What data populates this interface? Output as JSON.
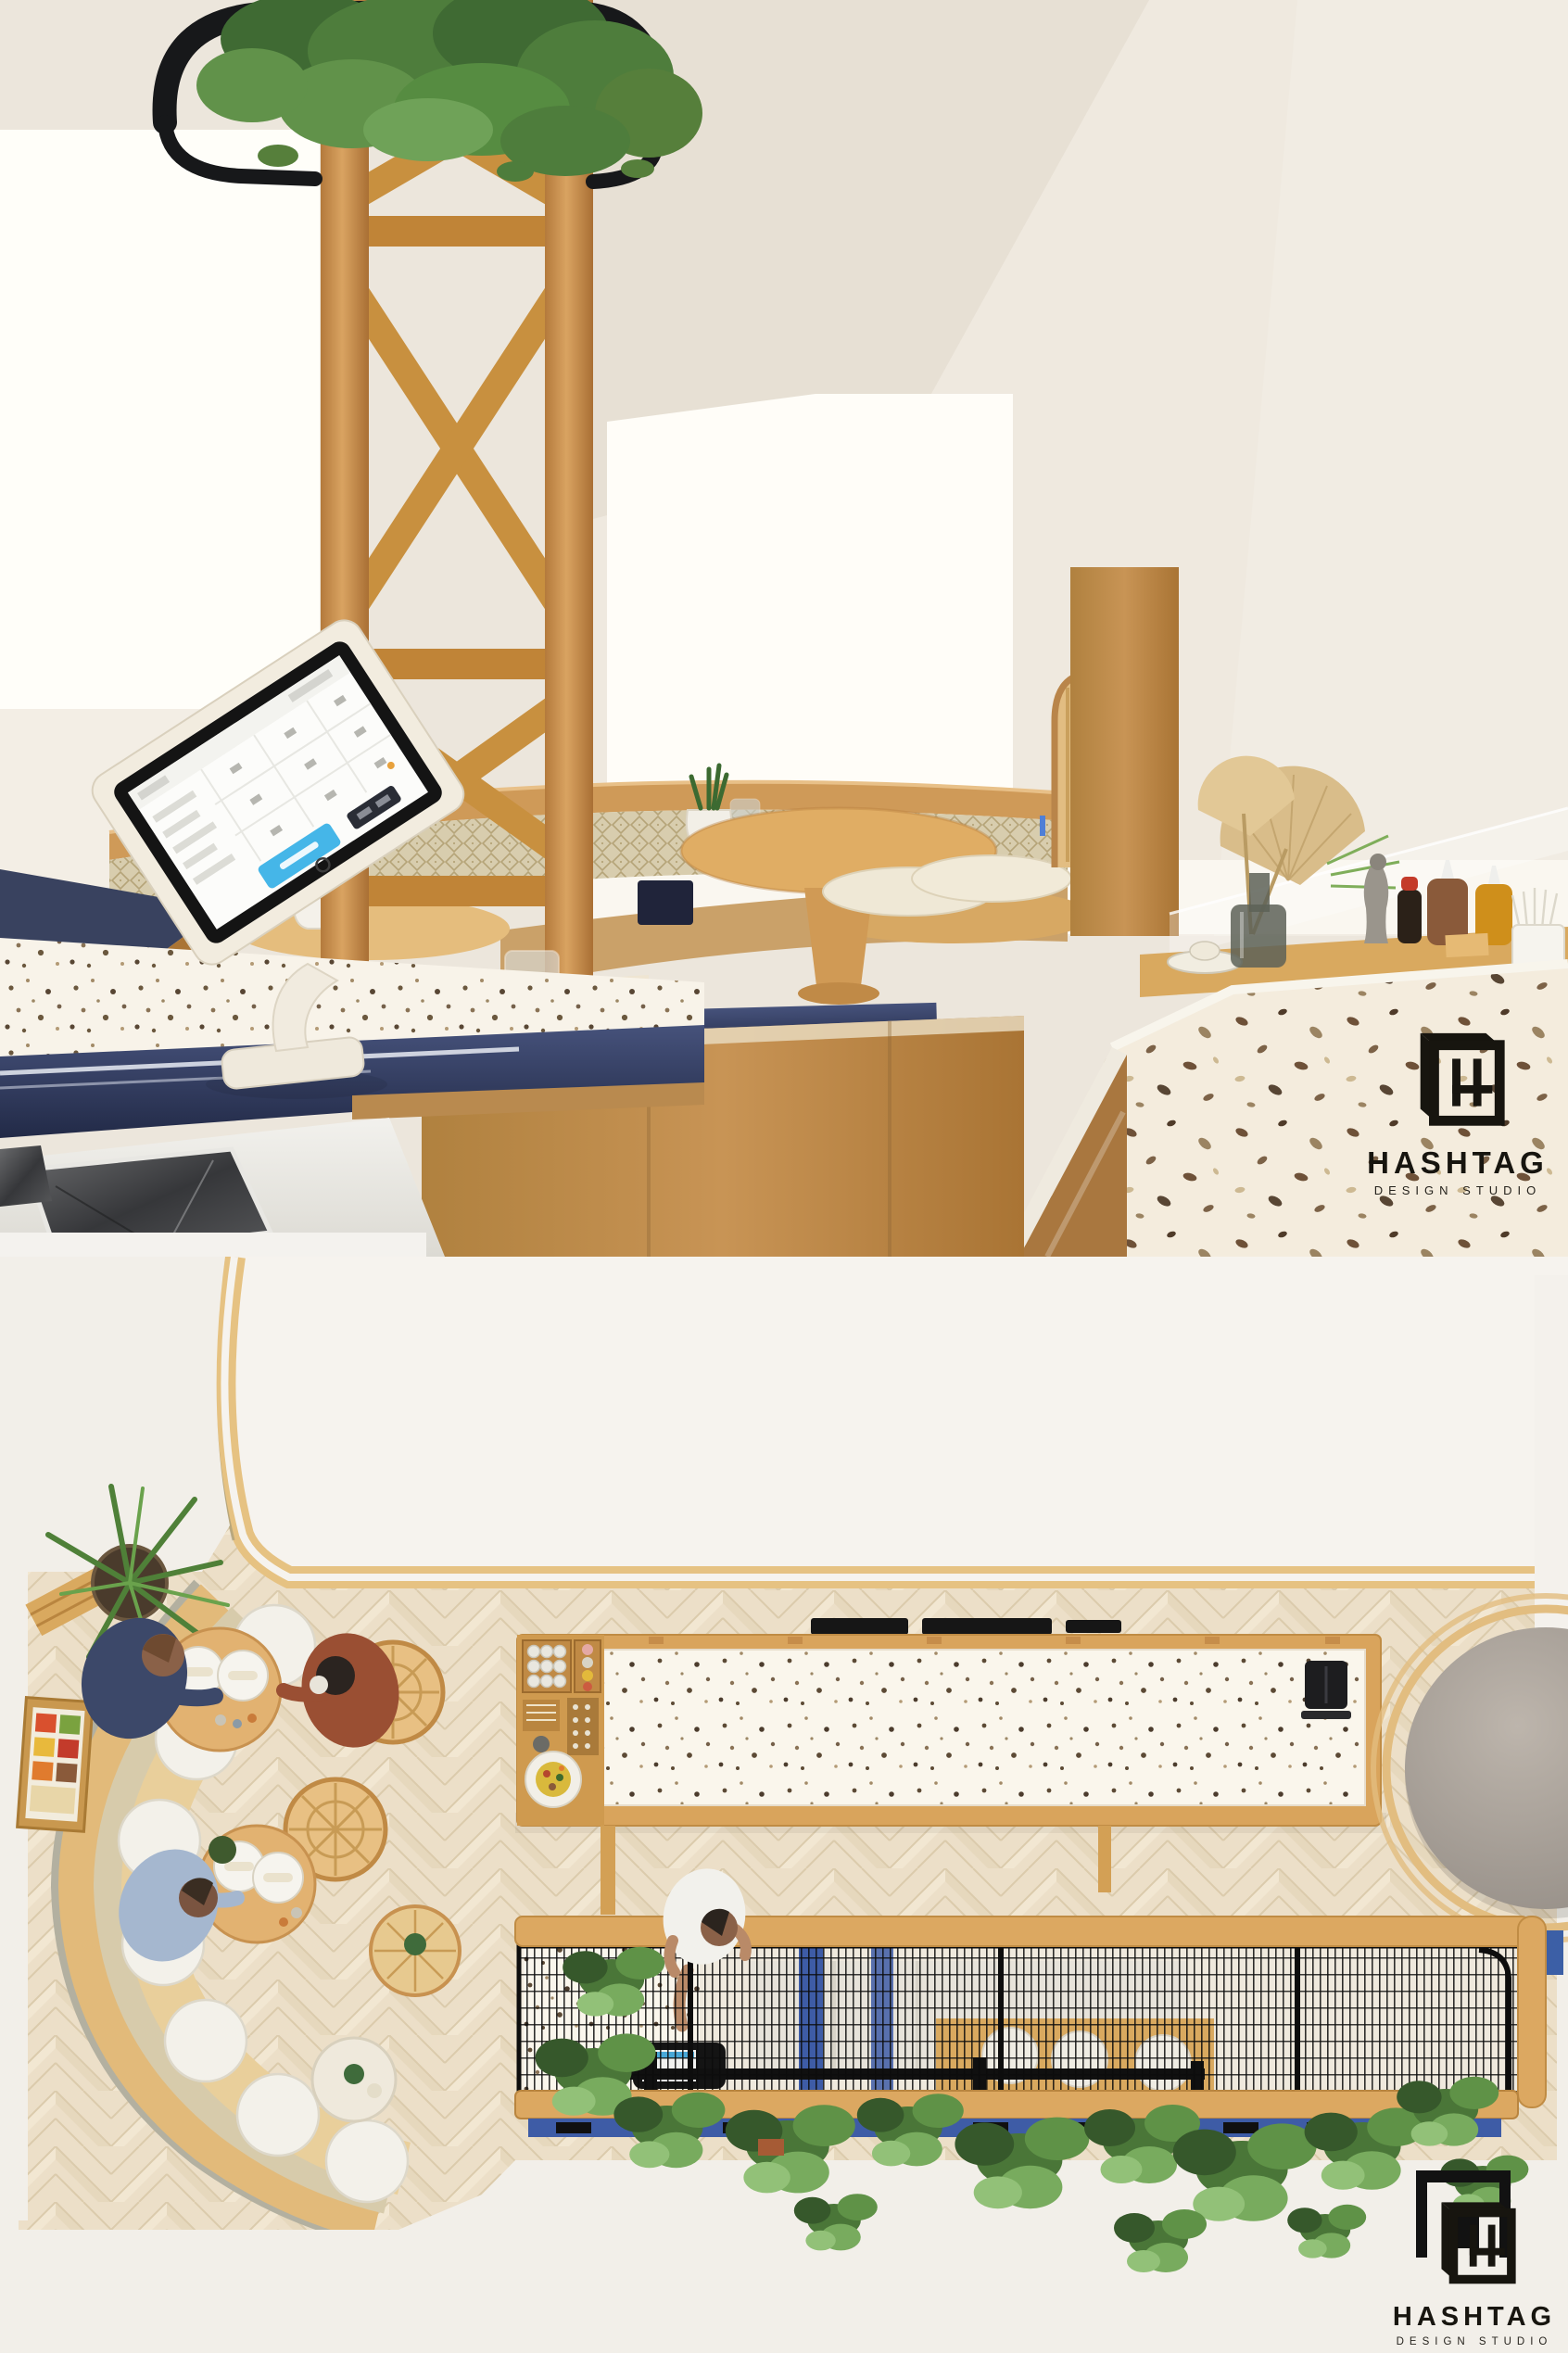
{
  "watermark": {
    "brand": "HASHTAG",
    "tagline": "DESIGN STUDIO"
  },
  "scene": {
    "type": "interior-design-render",
    "subject": "Cafe interior visualization: perspective view of service counters (top half) and top-down floor plan view (bottom half)",
    "views": [
      {
        "id": "perspective",
        "label": "Counter and seating perspective view",
        "elements": [
          "tree-canopy",
          "black-steel-planter-ring",
          "timber-x-braced-column",
          "pos-tablet-on-stand",
          "navy-counter-edges",
          "terrazzo-countertops",
          "stainless-steel-sink",
          "curved-booth-bench",
          "patterned-booth-cushions",
          "round-timber-pedestal-table",
          "potted-succulents",
          "plates-and-bowls",
          "wicker-chair",
          "timber-partition-panel",
          "glass-vase-with-dried-palm",
          "condiment-bottles",
          "pepper-grinder",
          "chopstick-cup",
          "glass-sneeze-guard",
          "terrazzo-island-counter",
          "timber-cabinetry",
          "white-dormer-window"
        ]
      },
      {
        "id": "plan",
        "label": "Top-down floor plan view",
        "elements": [
          "white-canopy-roof",
          "curved-timber-trim",
          "herringbone-timber-floor",
          "curved-banquette",
          "round-white-seat-cushions",
          "round-dining-tables",
          "place-settings",
          "seated-guests",
          "rattan-chairs",
          "palm-plant",
          "menu-board",
          "long-terrazzo-service-bar",
          "barista-cup-station",
          "plate-of-food",
          "black-espresso-equipment",
          "black-pos-device",
          "round-gray-canopy-top",
          "navy-accent-panels",
          "black-mesh-screen",
          "timber-rails",
          "standing-guest",
          "hanging-greenery",
          "black-side-table"
        ]
      }
    ]
  },
  "palette": {
    "wall": "#ece6dc",
    "window_light": "#fffef9",
    "timber": "#c68d4e",
    "timber_light": "#e3c18a",
    "navy_counter": "#333e5e",
    "accent_blue": "#3e5ca6",
    "pos_button_blue": "#45b6e8",
    "terrazzo_base": "#f6f1e6",
    "terrazzo_fleck": "#6b583e",
    "booth_fabric": "#d8cdae",
    "cushion_white": "#f3f1ea",
    "leaf_green": "#4a7638",
    "mesh_black": "#0d0d0d",
    "floor_wood": "#ecdfc8",
    "gray_canopy": "#a49c93",
    "steel": "#8d8f91",
    "logo_black": "#17150f"
  }
}
